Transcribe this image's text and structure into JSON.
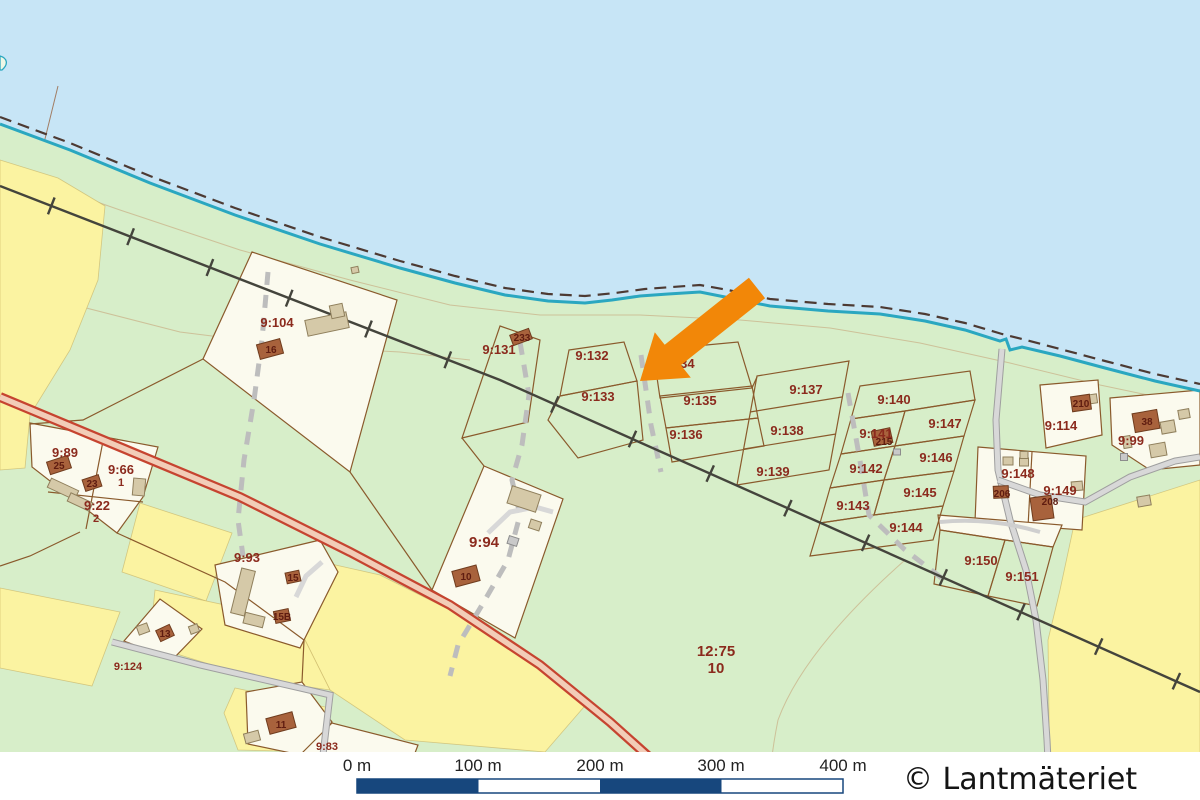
{
  "map": {
    "copyright": "© Lantmäteriet",
    "scale_bar": {
      "labels": [
        "0 m",
        "100 m",
        "200 m",
        "300 m",
        "400 m"
      ],
      "bar_color": "#17477d"
    },
    "marker": {
      "type": "orange-arrow",
      "color": "#F28708",
      "points_at": "boundary of 9:132 / 9:133"
    },
    "colors": {
      "water": "#c7e5f6",
      "land": "#d7eec9",
      "field": "#fbf3a1",
      "plot": "#fbfaee",
      "shoreline": "#2aa7c0",
      "parcel_line": "#8a5a2c",
      "label_red": "#8b2a1d",
      "road_red": "#c64430",
      "road_gray": "#d8d8d8"
    },
    "parcels": {
      "p9_104": "9:104",
      "p9_131": "9:131",
      "p9_132": "9:132",
      "p9_133": "9:133",
      "p9_134": "9:134",
      "p9_135": "9:135",
      "p9_136": "9:136",
      "p9_137": "9:137",
      "p9_138": "9:138",
      "p9_139": "9:139",
      "p9_140": "9:140",
      "p9_141": "9:141",
      "p9_142": "9:142",
      "p9_143": "9:143",
      "p9_144": "9:144",
      "p9_145": "9:145",
      "p9_146": "9:146",
      "p9_147": "9:147",
      "p9_148": "9:148",
      "p9_149": "9:149",
      "p9_150": "9:150",
      "p9_151": "9:151",
      "p9_114": "9:114",
      "p9_99": "9:99",
      "p9_89": "9:89",
      "p9_66": "9:66",
      "p9_66_unit": "1",
      "p9_22": "9:22",
      "p9_22_unit": "2",
      "p9_93": "9:93",
      "p9_94": "9:94",
      "p9_124": "9:124",
      "p9_83": "9:83",
      "p12_75": "12:75",
      "p12_75_unit": "10"
    },
    "buildings": {
      "b16": "16",
      "b233": "233",
      "b25": "25",
      "b23": "23",
      "b13": "13",
      "b15": "15",
      "b15b": "15B",
      "b10": "10",
      "b11": "11",
      "b210": "210",
      "b38": "38",
      "b215": "215",
      "b206": "206",
      "b208": "208"
    }
  }
}
